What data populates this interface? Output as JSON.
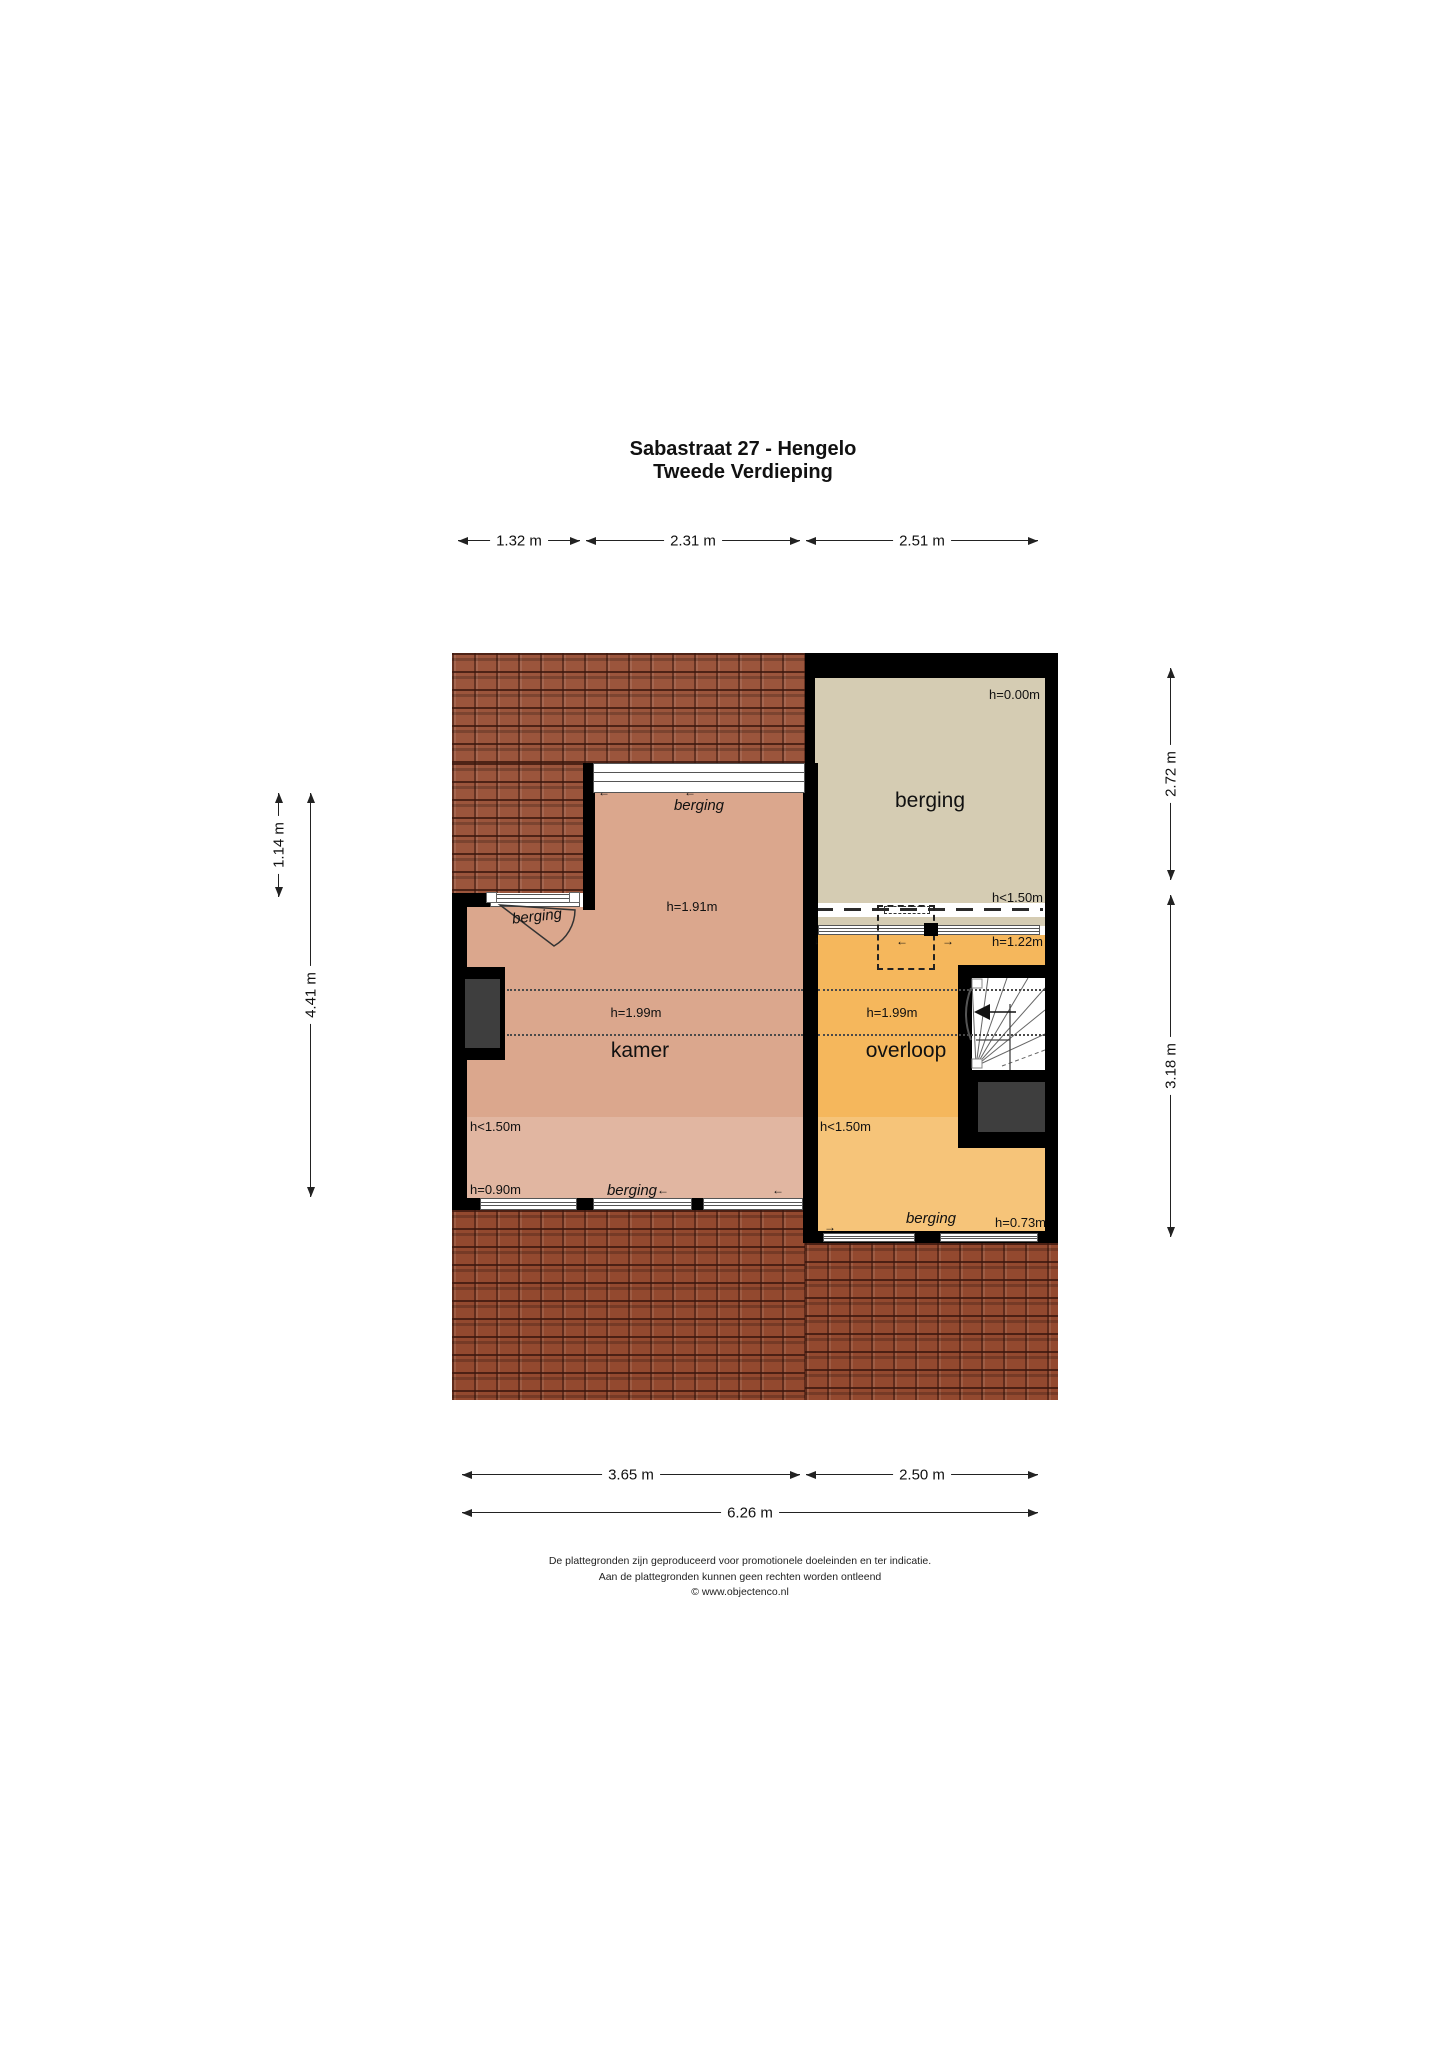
{
  "title": {
    "line1": "Sabastraat 27 - Hengelo",
    "line2": "Tweede Verdieping"
  },
  "dimensions": {
    "top": [
      "1.32 m",
      "2.31 m",
      "2.51 m"
    ],
    "left": [
      "1.14 m",
      "4.41 m"
    ],
    "right": [
      "2.72 m",
      "3.18 m"
    ],
    "bottom": [
      "3.65 m",
      "2.50 m",
      "6.26 m"
    ]
  },
  "rooms": {
    "berging": {
      "name": "berging",
      "h_ceiling": "h=0.00m",
      "h_edge": "h<1.50m"
    },
    "kamer": {
      "name": "kamer",
      "h_top": "h=1.91m",
      "h_mid": "h=1.99m",
      "h_low": "h<1.50m",
      "h_floor": "h=0.90m"
    },
    "overloop": {
      "name": "overloop",
      "h_top": "h=1.22m",
      "h_mid": "h=1.99m",
      "h_low": "h<1.50m",
      "h_floor": "h=0.73m"
    }
  },
  "window_labels": {
    "top": "berging",
    "door": "berging",
    "kamer_bottom": "berging",
    "overloop_bottom": "berging"
  },
  "arrows": {
    "left": "←",
    "right": "→",
    "down": "↓"
  },
  "footer": {
    "line1": "De plattegronden zijn geproduceerd voor promotionele doeleinden en ter indicatie.",
    "line2": "Aan de plattegronden kunnen geen rechten worden ontleend",
    "line3": "© www.objectenco.nl"
  },
  "colors": {
    "wall": "#000000",
    "berging": "#d5ccb3",
    "kamer": "#dba78d",
    "overloop": "#f5b75c",
    "shaft": "#3e3e3e",
    "roof": "#9b553c"
  }
}
